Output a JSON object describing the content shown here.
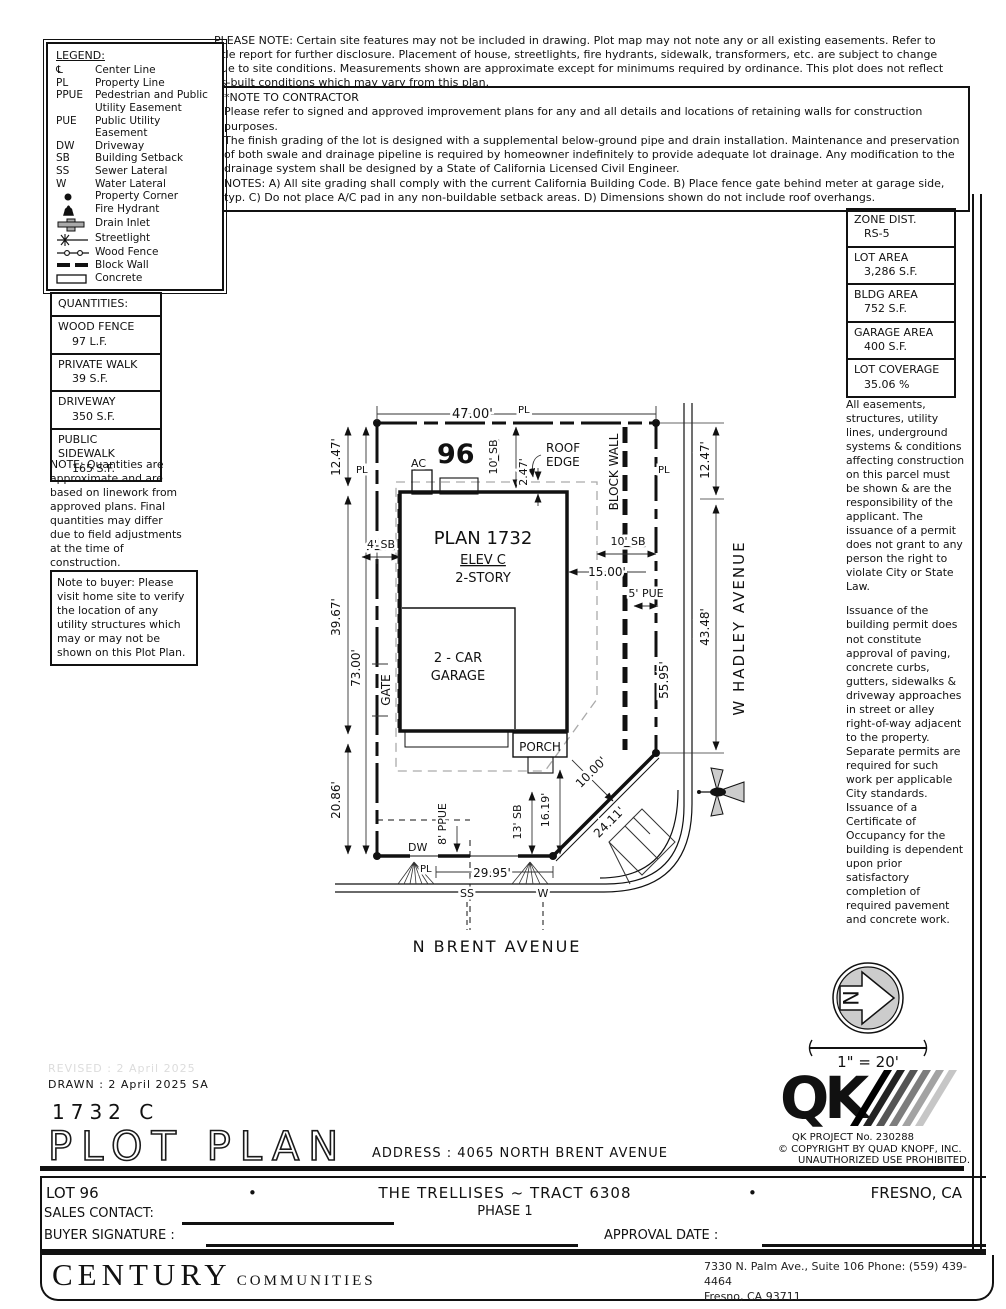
{
  "top_note": "PLEASE NOTE:  Certain site features may not be included in drawing.  Plot map may not note any or all existing easements. Refer to title report for further disclosure.  Placement of house, streetlights, fire hydrants, sidewalk, transformers, etc. are subject to change due to site conditions.  Measurements shown are approximate except for minimums required by ordinance.  This plot does not reflect as-built conditions which may vary from this plan.",
  "contractor": {
    "title": "*NOTE TO CONTRACTOR",
    "p1": "Please refer to signed and approved improvement plans for any and all details and locations of retaining walls for construction purposes.",
    "p2": "The finish grading of the lot is designed with a supplemental below-ground pipe and drain installation.  Maintenance and preservation of both swale and drainage pipeline is required by homeowner indefinitely to provide adequate lot drainage.  Any modification to the drainage system shall be designed by a State of California Licensed Civil Engineer.",
    "p3": "NOTES:  A) All site grading shall comply with the current California Building Code.  B) Place fence gate behind meter at garage side, typ.  C) Do not place A/C pad in any non-buildable setback areas.  D) Dimensions shown do not include roof overhangs."
  },
  "legend": {
    "title": "LEGEND:",
    "items": [
      {
        "abbr": "℄",
        "label": "Center Line"
      },
      {
        "abbr": "PL",
        "label": "Property Line"
      },
      {
        "abbr": "PPUE",
        "label": "Pedestrian and Public Utility Easement"
      },
      {
        "abbr": "PUE",
        "label": "Public Utility Easement"
      },
      {
        "abbr": "DW",
        "label": "Driveway"
      },
      {
        "abbr": "SB",
        "label": "Building Setback"
      },
      {
        "abbr": "SS",
        "label": "Sewer Lateral"
      },
      {
        "abbr": "W",
        "label": "Water Lateral"
      },
      {
        "icon": "property-corner-icon",
        "label": "Property Corner"
      },
      {
        "icon": "fire-hydrant-icon",
        "label": "Fire Hydrant"
      },
      {
        "icon": "drain-inlet-icon",
        "label": "Drain Inlet"
      },
      {
        "icon": "streetlight-icon",
        "label": "Streetlight"
      },
      {
        "icon": "wood-fence-icon",
        "label": "Wood Fence"
      },
      {
        "icon": "block-wall-icon",
        "label": "Block Wall"
      },
      {
        "icon": "concrete-icon",
        "label": "Concrete"
      }
    ]
  },
  "zone": {
    "rows": [
      {
        "label": "ZONE DIST.",
        "value": "RS-5"
      },
      {
        "label": "LOT AREA",
        "value": "3,286 S.F."
      },
      {
        "label": "BLDG AREA",
        "value": "752 S.F."
      },
      {
        "label": "GARAGE AREA",
        "value": "400 S.F."
      },
      {
        "label": "LOT COVERAGE",
        "value": "35.06 %"
      }
    ]
  },
  "quantities": {
    "title": "QUANTITIES:",
    "rows": [
      {
        "label": "WOOD FENCE",
        "value": "97 L.F."
      },
      {
        "label": "PRIVATE WALK",
        "value": "39 S.F."
      },
      {
        "label": "DRIVEWAY",
        "value": "350 S.F."
      },
      {
        "label": "PUBLIC SIDEWALK",
        "value": "165 S.F."
      }
    ]
  },
  "quantities_note": "NOTE: Quantities are approximate and are based on linework from approved plans.  Final quantities may differ due to field adjustments at the time of construction.",
  "buyer_note": "Note to buyer: Please visit home site to verify the location of any utility structures which may or may not be shown on this Plot Plan.",
  "right_notes": {
    "p1": "All easements, structures, utility lines, underground systems & conditions affecting construction on this parcel must be shown & are the responsibility of the applicant. The issuance of a permit does not grant to any person the right to violate City or State Law.",
    "p2": "Issuance of the building permit does not constitute approval of paving, concrete curbs, gutters, sidewalks & driveway approaches in street or alley right-of-way adjacent to the property. Separate permits are required for such work per applicable City standards. Issuance of a Certificate of Occupancy for the building is dependent upon prior satisfactory completion of required pavement and concrete work."
  },
  "plot": {
    "lot_number": "96",
    "pl": "PL",
    "dim_top": "47.00'",
    "dim_left1": "12.47'",
    "dim_left2": "39.67'",
    "dim_left3": "20.86'",
    "dim_left_total": "73.00'",
    "sb_top": "10' SB",
    "roof_overhang": "2.47'",
    "roof_edge_1": "ROOF",
    "roof_edge_2": "EDGE",
    "ac": "AC",
    "sb_left": "4' SB",
    "plan": "PLAN 1732",
    "elev": "ELEV C",
    "story": "2-STORY",
    "block_wall": "BLOCK WALL",
    "sb_right": "10' SB",
    "dim_15": "15.00'",
    "pue": "5' PUE",
    "dim_right_pl": "55.95'",
    "gate": "GATE",
    "garage_1": "2 - CAR",
    "garage_2": "GARAGE",
    "porch": "PORCH",
    "dim_diag_1": "10.00'",
    "dim_diag_2": "24.11'",
    "dim_16": "16.19'",
    "sb_13": "13' SB",
    "ppue": "8' PPUE",
    "dw": "DW",
    "dim_bottom": "29.95'",
    "ss": "SS",
    "w": "W",
    "street_bottom": "N BRENT AVENUE",
    "street_right": "W HADLEY AVENUE",
    "dim_r1": "12.47'",
    "dim_r2": "43.48'"
  },
  "north": {
    "letter": "N",
    "scale": "1\" = 20'"
  },
  "titleblock": {
    "revised": "REVISED :  2 April 2025",
    "drawn": "DRAWN :  2 April 2025  SA",
    "plan_code": "1732  C",
    "title": "PLOT PLAN",
    "address": "ADDRESS :  4065 NORTH BRENT AVENUE",
    "qk": "QK",
    "qk_project": "QK PROJECT No. 230288",
    "copyright1": "©  COPYRIGHT BY QUAD KNOPF, INC.",
    "copyright2": "UNAUTHORIZED USE PROHIBITED.",
    "lot": "LOT 96",
    "bullet": "•",
    "tract": "THE TRELLISES ~ TRACT 6308",
    "phase": "PHASE 1",
    "city": "FRESNO, CA",
    "sales": "SALES CONTACT:",
    "buyer": "BUYER SIGNATURE :",
    "approval": "APPROVAL DATE :",
    "century": "CENTURY",
    "communities": "COMMUNITIES",
    "addr1": "7330 N. Palm Ave., Suite 106    Phone:  (559) 439-4464",
    "addr2": "Fresno, CA  93711"
  }
}
